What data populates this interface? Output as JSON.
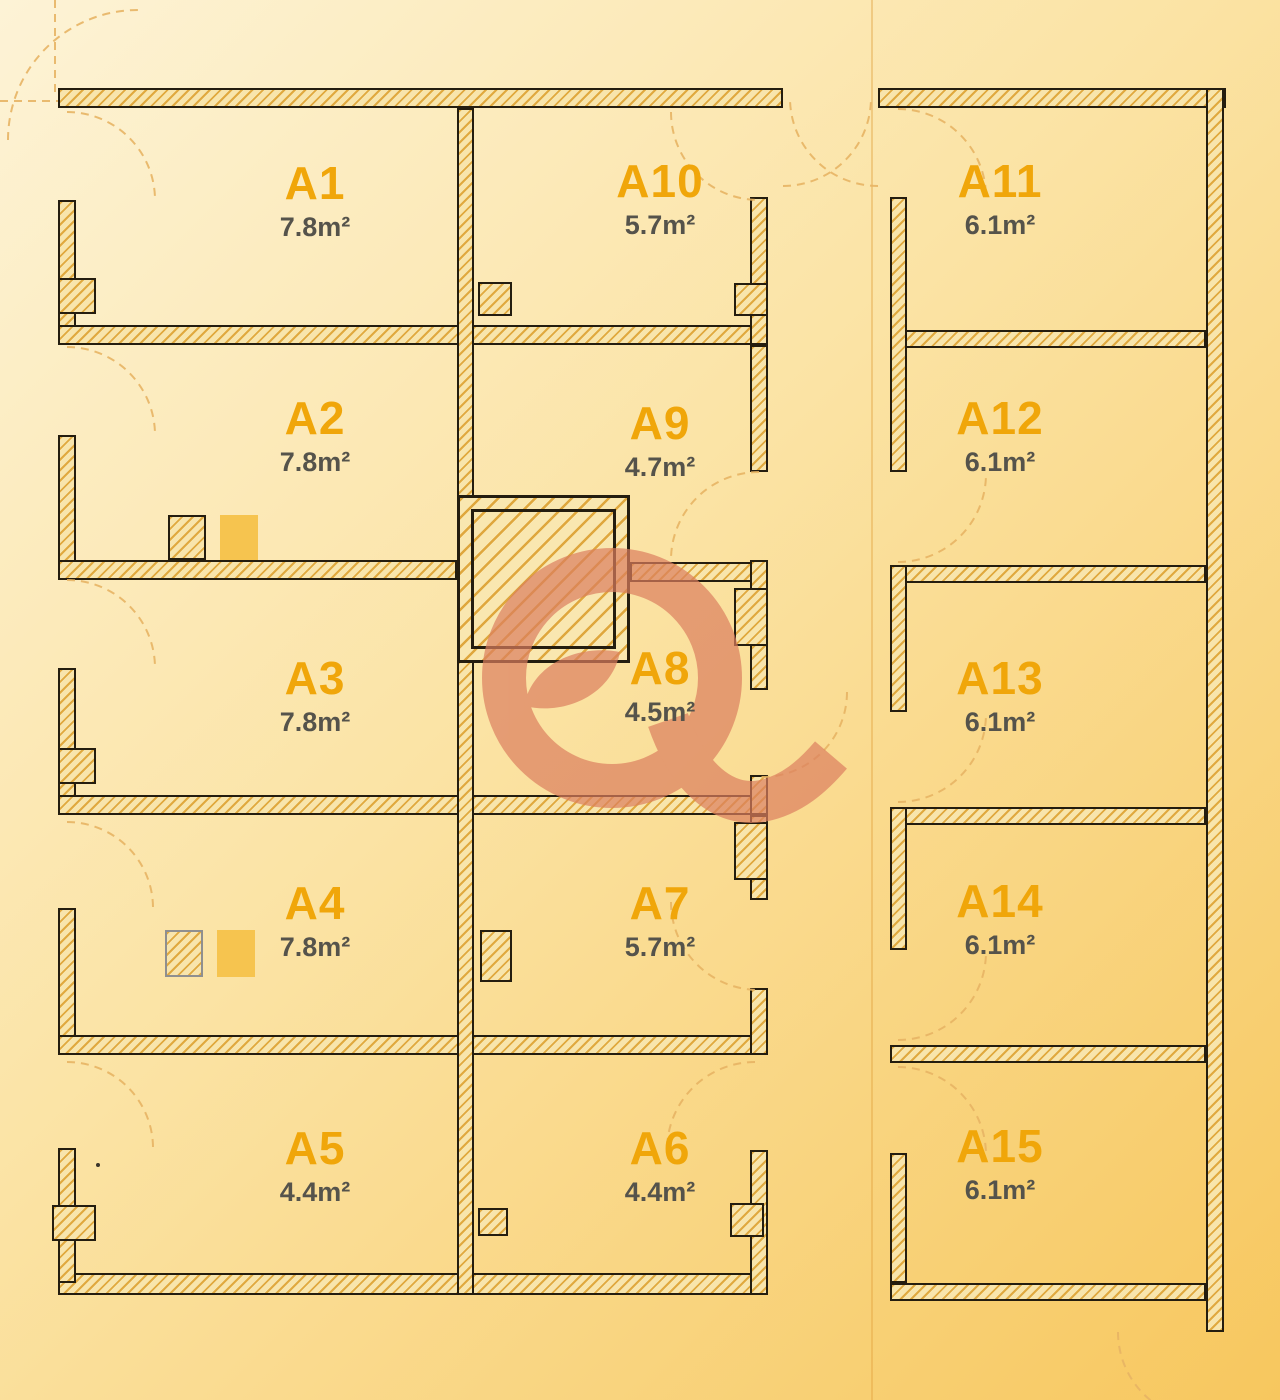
{
  "plan": {
    "type": "floor-plan",
    "accent_color": "#f0a60a",
    "watermark_color": "#dc7f5f",
    "wall_hatch_color": "#e0a93f",
    "background_top": "#fdf3d6",
    "background_bottom": "#f7c75e"
  },
  "rooms": [
    {
      "id": "A1",
      "area": "7.8m²"
    },
    {
      "id": "A2",
      "area": "7.8m²"
    },
    {
      "id": "A3",
      "area": "7.8m²"
    },
    {
      "id": "A4",
      "area": "7.8m²"
    },
    {
      "id": "A5",
      "area": "4.4m²"
    },
    {
      "id": "A6",
      "area": "4.4m²"
    },
    {
      "id": "A7",
      "area": "5.7m²"
    },
    {
      "id": "A8",
      "area": "4.5m²"
    },
    {
      "id": "A9",
      "area": "4.7m²"
    },
    {
      "id": "A10",
      "area": "5.7m²"
    },
    {
      "id": "A11",
      "area": "6.1m²"
    },
    {
      "id": "A12",
      "area": "6.1m²"
    },
    {
      "id": "A13",
      "area": "6.1m²"
    },
    {
      "id": "A14",
      "area": "6.1m²"
    },
    {
      "id": "A15",
      "area": "6.1m²"
    }
  ]
}
